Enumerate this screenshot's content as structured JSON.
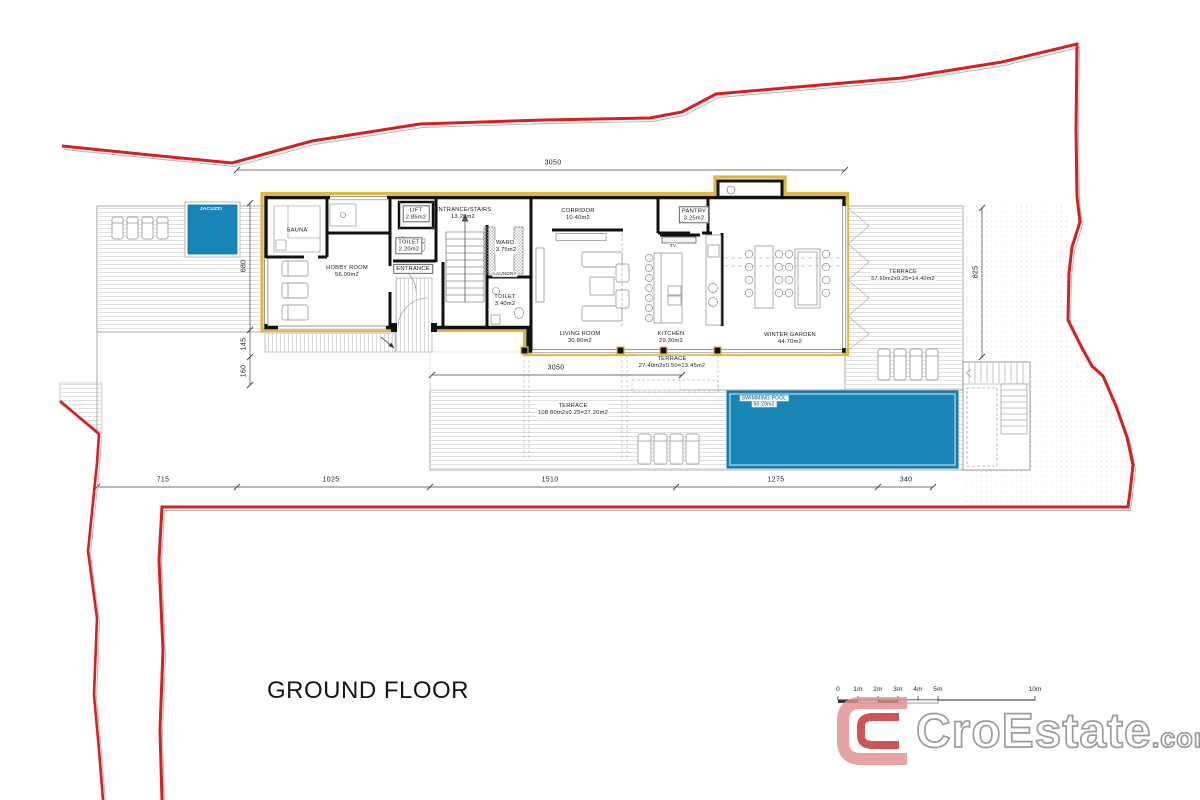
{
  "floor_title": "GROUND FLOOR",
  "rooms": {
    "sauna": {
      "name": "SAUNA"
    },
    "hobby": {
      "name": "HOBBY ROOM",
      "area": "56.00m2"
    },
    "lift": {
      "name": "LIFT",
      "area": "2.85m2"
    },
    "stairs": {
      "name": "ENTRANCE/STAIRS",
      "area": "13.20m2"
    },
    "toilet1": {
      "name": "TOILET",
      "area": "2.20m2"
    },
    "entrance": {
      "name": "ENTRANCE"
    },
    "ward": {
      "name": "WARD.",
      "area": "3.75m2"
    },
    "laundry": {
      "name": "LAUNDRY"
    },
    "toilet2": {
      "name": "TOILET",
      "area": "3.40m2"
    },
    "corridor": {
      "name": "CORRIDOR",
      "area": "10.40m2"
    },
    "pantry": {
      "name": "PANTRY",
      "area": "3.25m2"
    },
    "tv": {
      "name": "TV"
    },
    "living": {
      "name": "LIVING ROOM",
      "area": "30.80m2"
    },
    "kitchen": {
      "name": "KITCHEN",
      "area": "29.30m2"
    },
    "winter_garden": {
      "name": "WINTER GARDEN",
      "area": "44.70m2"
    }
  },
  "outdoor": {
    "jacuzzi": {
      "name": "JACUZZI"
    },
    "pool": {
      "name": "SWIMMING POOL",
      "area": "50.20m2"
    },
    "terrace_east": {
      "name": "TERRACE",
      "area": "57.60m2x0.25=14.40m2"
    },
    "terrace_south": {
      "name": "TERRACE",
      "area": "27.40m2x0.50=13.45m2"
    },
    "terrace_main": {
      "name": "TERRACE",
      "area": "108.80m2x0.25=27.20m2"
    }
  },
  "dimensions": {
    "top_width": "3050",
    "south_width": "3050",
    "left": [
      "680",
      "145",
      "160"
    ],
    "east_depth": "825",
    "bottom": [
      "715",
      "1025",
      "1510",
      "1275",
      "340"
    ]
  },
  "scale_bar": {
    "labels": [
      "0",
      "1m",
      "2m",
      "3m",
      "4m",
      "5m",
      "10m"
    ]
  },
  "branding": {
    "brand": "CroEstate",
    "suffix": ".com"
  },
  "colors": {
    "boundary_red": "#d81e1e",
    "water_blue": "#1887b8",
    "insulation_yellow": "#ddb83c"
  }
}
